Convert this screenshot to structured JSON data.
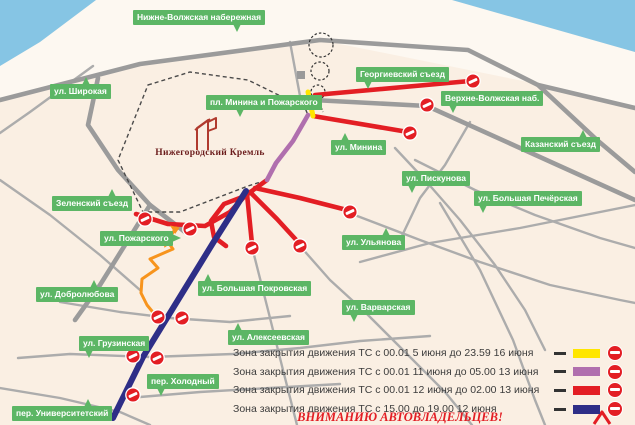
{
  "map": {
    "colors": {
      "water": "#86C5E4",
      "land": "#FAEFE3",
      "beach": "#FDF8F1",
      "road_main": "#9B9B9B",
      "road_minor": "#ACACAC",
      "label_bg": "#5CB665",
      "label_text": "#FFFFFF",
      "kremlin_wall": "#4A4A4A",
      "kremlin_text": "#6B1C1C",
      "yellow": "#FFE600",
      "purple": "#B06FAE",
      "red": "#E31E24",
      "navy": "#2E2E87",
      "orange": "#F7941D",
      "no_entry": "#E31E24",
      "legend_text": "#3C3C3C",
      "attention": "#E31E24"
    },
    "water_polys": [
      [
        [
          0,
          0
        ],
        [
          96,
          0
        ],
        [
          40,
          42
        ],
        [
          0,
          66
        ]
      ],
      [
        [
          452,
          0
        ],
        [
          635,
          0
        ],
        [
          635,
          52
        ]
      ]
    ],
    "beach_poly": [
      [
        96,
        0
      ],
      [
        452,
        0
      ],
      [
        635,
        52
      ],
      [
        635,
        106
      ],
      [
        538,
        84
      ],
      [
        320,
        40
      ],
      [
        140,
        64
      ],
      [
        0,
        98
      ],
      [
        0,
        66
      ],
      [
        40,
        42
      ]
    ],
    "roads_main": [
      [
        [
          0,
          100
        ],
        [
          140,
          64
        ],
        [
          320,
          40
        ],
        [
          468,
          50
        ],
        [
          538,
          85
        ],
        [
          635,
          108
        ]
      ],
      [
        [
          538,
          85
        ],
        [
          597,
          140
        ],
        [
          635,
          172
        ]
      ],
      [
        [
          313,
          100
        ],
        [
          427,
          106
        ],
        [
          520,
          148
        ],
        [
          635,
          200
        ]
      ],
      [
        [
          98,
          78
        ],
        [
          88,
          125
        ],
        [
          118,
          170
        ],
        [
          150,
          205
        ],
        [
          185,
          232
        ]
      ],
      [
        [
          150,
          205
        ],
        [
          125,
          245
        ],
        [
          100,
          285
        ],
        [
          75,
          320
        ]
      ]
    ],
    "roads_minor": [
      [
        [
          93,
          66
        ],
        [
          30,
          112
        ],
        [
          0,
          133
        ]
      ],
      [
        [
          290,
          42
        ],
        [
          300,
          96
        ]
      ],
      [
        [
          352,
          214
        ],
        [
          420,
          240
        ],
        [
          480,
          262
        ],
        [
          550,
          285
        ],
        [
          620,
          300
        ],
        [
          635,
          303
        ]
      ],
      [
        [
          300,
          246
        ],
        [
          330,
          280
        ],
        [
          365,
          312
        ],
        [
          405,
          352
        ],
        [
          445,
          392
        ],
        [
          472,
          425
        ]
      ],
      [
        [
          252,
          247
        ],
        [
          268,
          310
        ],
        [
          283,
          370
        ],
        [
          297,
          425
        ]
      ],
      [
        [
          395,
          148
        ],
        [
          425,
          180
        ],
        [
          460,
          220
        ],
        [
          495,
          265
        ],
        [
          525,
          310
        ],
        [
          545,
          350
        ]
      ],
      [
        [
          415,
          160
        ],
        [
          475,
          190
        ],
        [
          535,
          215
        ],
        [
          600,
          238
        ],
        [
          635,
          248
        ]
      ],
      [
        [
          60,
          302
        ],
        [
          120,
          312
        ],
        [
          170,
          318
        ],
        [
          230,
          322
        ],
        [
          290,
          316
        ]
      ],
      [
        [
          18,
          358
        ],
        [
          70,
          354
        ],
        [
          150,
          357
        ],
        [
          233,
          354
        ],
        [
          300,
          348
        ],
        [
          360,
          341
        ],
        [
          430,
          336
        ]
      ],
      [
        [
          140,
          397
        ],
        [
          200,
          392
        ],
        [
          270,
          388
        ],
        [
          340,
          384
        ]
      ],
      [
        [
          0,
          388
        ],
        [
          60,
          398
        ],
        [
          120,
          412
        ],
        [
          150,
          425
        ]
      ],
      [
        [
          440,
          203
        ],
        [
          480,
          270
        ],
        [
          513,
          340
        ],
        [
          535,
          400
        ],
        [
          545,
          425
        ]
      ],
      [
        [
          360,
          262
        ],
        [
          430,
          243
        ],
        [
          520,
          228
        ],
        [
          635,
          205
        ]
      ],
      [
        [
          470,
          122
        ],
        [
          445,
          165
        ],
        [
          420,
          198
        ],
        [
          400,
          240
        ]
      ],
      [
        [
          0,
          180
        ],
        [
          50,
          215
        ],
        [
          100,
          255
        ],
        [
          140,
          290
        ]
      ]
    ],
    "kremlin_wall": [
      [
        148,
        85
      ],
      [
        190,
        72
      ],
      [
        248,
        80
      ],
      [
        305,
        108
      ],
      [
        308,
        115
      ],
      [
        267,
        180
      ],
      [
        248,
        186
      ],
      [
        180,
        212
      ],
      [
        143,
        212
      ],
      [
        118,
        160
      ]
    ],
    "stairs_circles": [
      {
        "cx": 321,
        "cy": 45,
        "r": 12
      },
      {
        "cx": 320,
        "cy": 71,
        "r": 9
      },
      {
        "cx": 318,
        "cy": 92,
        "r": 7
      }
    ],
    "stairs_tail": [
      [
        318,
        99
      ],
      [
        323,
        112
      ]
    ],
    "monument": {
      "x": 297,
      "y": 71,
      "w": 8,
      "h": 8
    },
    "tower_lines": [
      [
        [
          197,
          150
        ],
        [
          197,
          128
        ],
        [
          208,
          120
        ],
        [
          208,
          150
        ]
      ],
      [
        [
          208,
          122
        ],
        [
          216,
          118
        ],
        [
          216,
          128
        ],
        [
          208,
          131
        ]
      ],
      [
        [
          195,
          130
        ],
        [
          210,
          119
        ]
      ]
    ],
    "closures": [
      {
        "zone": "red",
        "pts": [
          [
            267,
            180
          ],
          [
            245,
            196
          ]
        ]
      },
      {
        "zone": "red",
        "pts": [
          [
            136,
            214
          ],
          [
            168,
            224
          ],
          [
            205,
            226
          ],
          [
            230,
            212
          ],
          [
            245,
            196
          ]
        ]
      },
      {
        "zone": "red",
        "pts": [
          [
            245,
            196
          ],
          [
            224,
            204
          ],
          [
            211,
            221
          ],
          [
            214,
            237
          ],
          [
            226,
            246
          ]
        ]
      },
      {
        "zone": "red",
        "pts": [
          [
            247,
            194
          ],
          [
            252,
            244
          ]
        ]
      },
      {
        "zone": "red",
        "pts": [
          [
            250,
            192
          ],
          [
            277,
            219
          ],
          [
            299,
            243
          ]
        ]
      },
      {
        "zone": "red",
        "pts": [
          [
            255,
            188
          ],
          [
            300,
            198
          ],
          [
            347,
            210
          ]
        ]
      },
      {
        "zone": "red",
        "pts": [
          [
            313,
            116
          ],
          [
            408,
            132
          ]
        ]
      },
      {
        "zone": "red",
        "pts": [
          [
            315,
            95
          ],
          [
            470,
            81
          ]
        ]
      },
      {
        "zone": "yellow",
        "pts": [
          [
            308,
            92
          ],
          [
            313,
            116
          ]
        ]
      },
      {
        "zone": "purple",
        "pts": [
          [
            308,
            115
          ],
          [
            293,
            141
          ],
          [
            276,
            163
          ],
          [
            267,
            180
          ]
        ]
      },
      {
        "zone": "navy",
        "pts": [
          [
            246,
            191
          ],
          [
            213,
            243
          ],
          [
            178,
            300
          ],
          [
            143,
            357
          ],
          [
            113,
            418
          ]
        ]
      }
    ],
    "detour": {
      "pts": [
        [
          176,
          228
        ],
        [
          167,
          241
        ],
        [
          173,
          249
        ],
        [
          150,
          259
        ],
        [
          158,
          268
        ],
        [
          142,
          279
        ],
        [
          141,
          293
        ],
        [
          147,
          305
        ],
        [
          156,
          316
        ]
      ],
      "arrows": [
        {
          "x": 175,
          "y": 229,
          "rot": -55
        },
        {
          "x": 166,
          "y": 243,
          "rot": -35
        }
      ]
    },
    "no_entry_points": [
      [
        473,
        81
      ],
      [
        427,
        105
      ],
      [
        410,
        133
      ],
      [
        350,
        212
      ],
      [
        145,
        219
      ],
      [
        190,
        229
      ],
      [
        252,
        248
      ],
      [
        300,
        246
      ],
      [
        158,
        317
      ],
      [
        182,
        318
      ],
      [
        133,
        356
      ],
      [
        157,
        358
      ],
      [
        133,
        395
      ]
    ],
    "corner_chevron": [
      [
        594,
        424
      ],
      [
        602,
        412
      ],
      [
        610,
        424
      ]
    ],
    "kremlin_label": "Нижегородский Кремль",
    "street_labels": [
      {
        "text": "Нижне-Волжская набережная",
        "x": 133,
        "y": 10,
        "tail": "down",
        "tdx": 100
      },
      {
        "text": "ул. Широкая",
        "x": 50,
        "y": 84,
        "tail": "up",
        "tdx": 32
      },
      {
        "text": "пл. Минина и Пожарского",
        "x": 206,
        "y": 95,
        "tail": "down",
        "tdx": 30
      },
      {
        "text": "Георгиевский съезд",
        "x": 356,
        "y": 67,
        "tail": "down",
        "tdx": 8
      },
      {
        "text": "Верхне-Волжская наб.",
        "x": 441,
        "y": 91,
        "tail": "down",
        "tdx": 8
      },
      {
        "text": "Казанский съезд",
        "x": 521,
        "y": 137,
        "tail": "up",
        "tdx": 58
      },
      {
        "text": "ул. Минина",
        "x": 331,
        "y": 140,
        "tail": "up",
        "tdx": 10
      },
      {
        "text": "ул. Пискунова",
        "x": 402,
        "y": 171,
        "tail": "down",
        "tdx": 6
      },
      {
        "text": "ул. Ульянова",
        "x": 342,
        "y": 235,
        "tail": "up",
        "tdx": 40
      },
      {
        "text": "ул. Большая Печёрская",
        "x": 474,
        "y": 191,
        "tail": "down",
        "tdx": 5
      },
      {
        "text": "Зеленский съезд",
        "x": 52,
        "y": 196,
        "tail": "up",
        "tdx": 56
      },
      {
        "text": "ул. Пожарского",
        "x": 100,
        "y": 231,
        "tail": "right",
        "tdx": 0
      },
      {
        "text": "ул. Добролюбова",
        "x": 36,
        "y": 287,
        "tail": "up",
        "tdx": 54
      },
      {
        "text": "ул. Большая Покровская",
        "x": 198,
        "y": 281,
        "tail": "up",
        "tdx": 6
      },
      {
        "text": "ул. Варварская",
        "x": 342,
        "y": 300,
        "tail": "down",
        "tdx": 8
      },
      {
        "text": "ул. Алексеевская",
        "x": 228,
        "y": 330,
        "tail": "up",
        "tdx": 6
      },
      {
        "text": "ул. Грузинская",
        "x": 79,
        "y": 336,
        "tail": "down",
        "tdx": 6
      },
      {
        "text": "пер. Холодный",
        "x": 147,
        "y": 374,
        "tail": "down",
        "tdx": 10
      },
      {
        "text": "пер. Университетский",
        "x": 12,
        "y": 406,
        "tail": "up",
        "tdx": 72
      }
    ]
  },
  "legend": {
    "rows": [
      {
        "zone": "yellow",
        "text": "Зона закрытия движения ТС с 00.01 5 июня до 23.59 16 июня"
      },
      {
        "zone": "purple",
        "text": "Зона закрытия движения ТС с 00.01 11 июня до 05.00 13 июня"
      },
      {
        "zone": "red",
        "text": "Зона закрытия движения ТС с 00.01 12 июня до 02.00 13 июня"
      },
      {
        "zone": "navy",
        "text": "Зона закрытия движения ТС с 15.00 до 19.00 12 июня"
      }
    ],
    "attention": "ВНИМАНИЮ АВТОВЛАДЕЛЬЦЕВ!"
  }
}
